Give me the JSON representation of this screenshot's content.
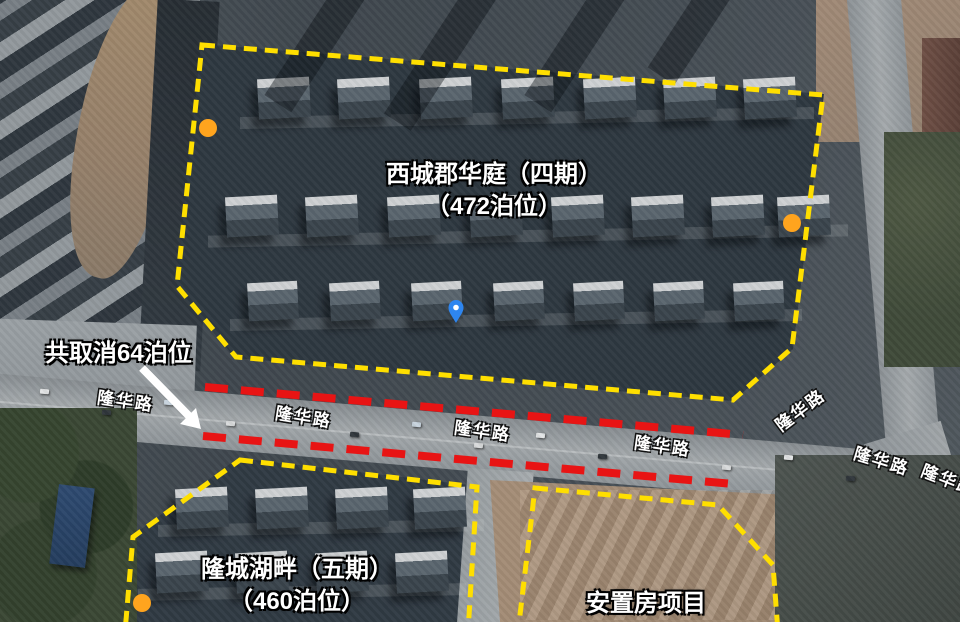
{
  "zones": {
    "xicheng": {
      "line1": "西城郡华庭（四期）",
      "line2": "（472泊位）"
    },
    "longcheng": {
      "line1": "隆城湖畔（五期）",
      "line2": "（460泊位）"
    },
    "anzhifang": {
      "line1": "安置房项目"
    }
  },
  "callout": {
    "text": "共取消64泊位"
  },
  "road_labels": [
    "隆华路",
    "隆华路",
    "隆华路",
    "隆华路",
    "隆华路",
    "隆华路",
    "隆华路"
  ],
  "markers": {
    "orange_dot_count": "3",
    "orange_dot_name": "orange-dot-marker",
    "blue_pin_name": "blue-location-pin"
  },
  "colors": {
    "boundary_yellow": "#ffdf00",
    "cancel_red": "#e81414",
    "marker_orange": "#ffa41e",
    "pin_blue": "#2e86f0",
    "arrow_white": "#ffffff"
  }
}
